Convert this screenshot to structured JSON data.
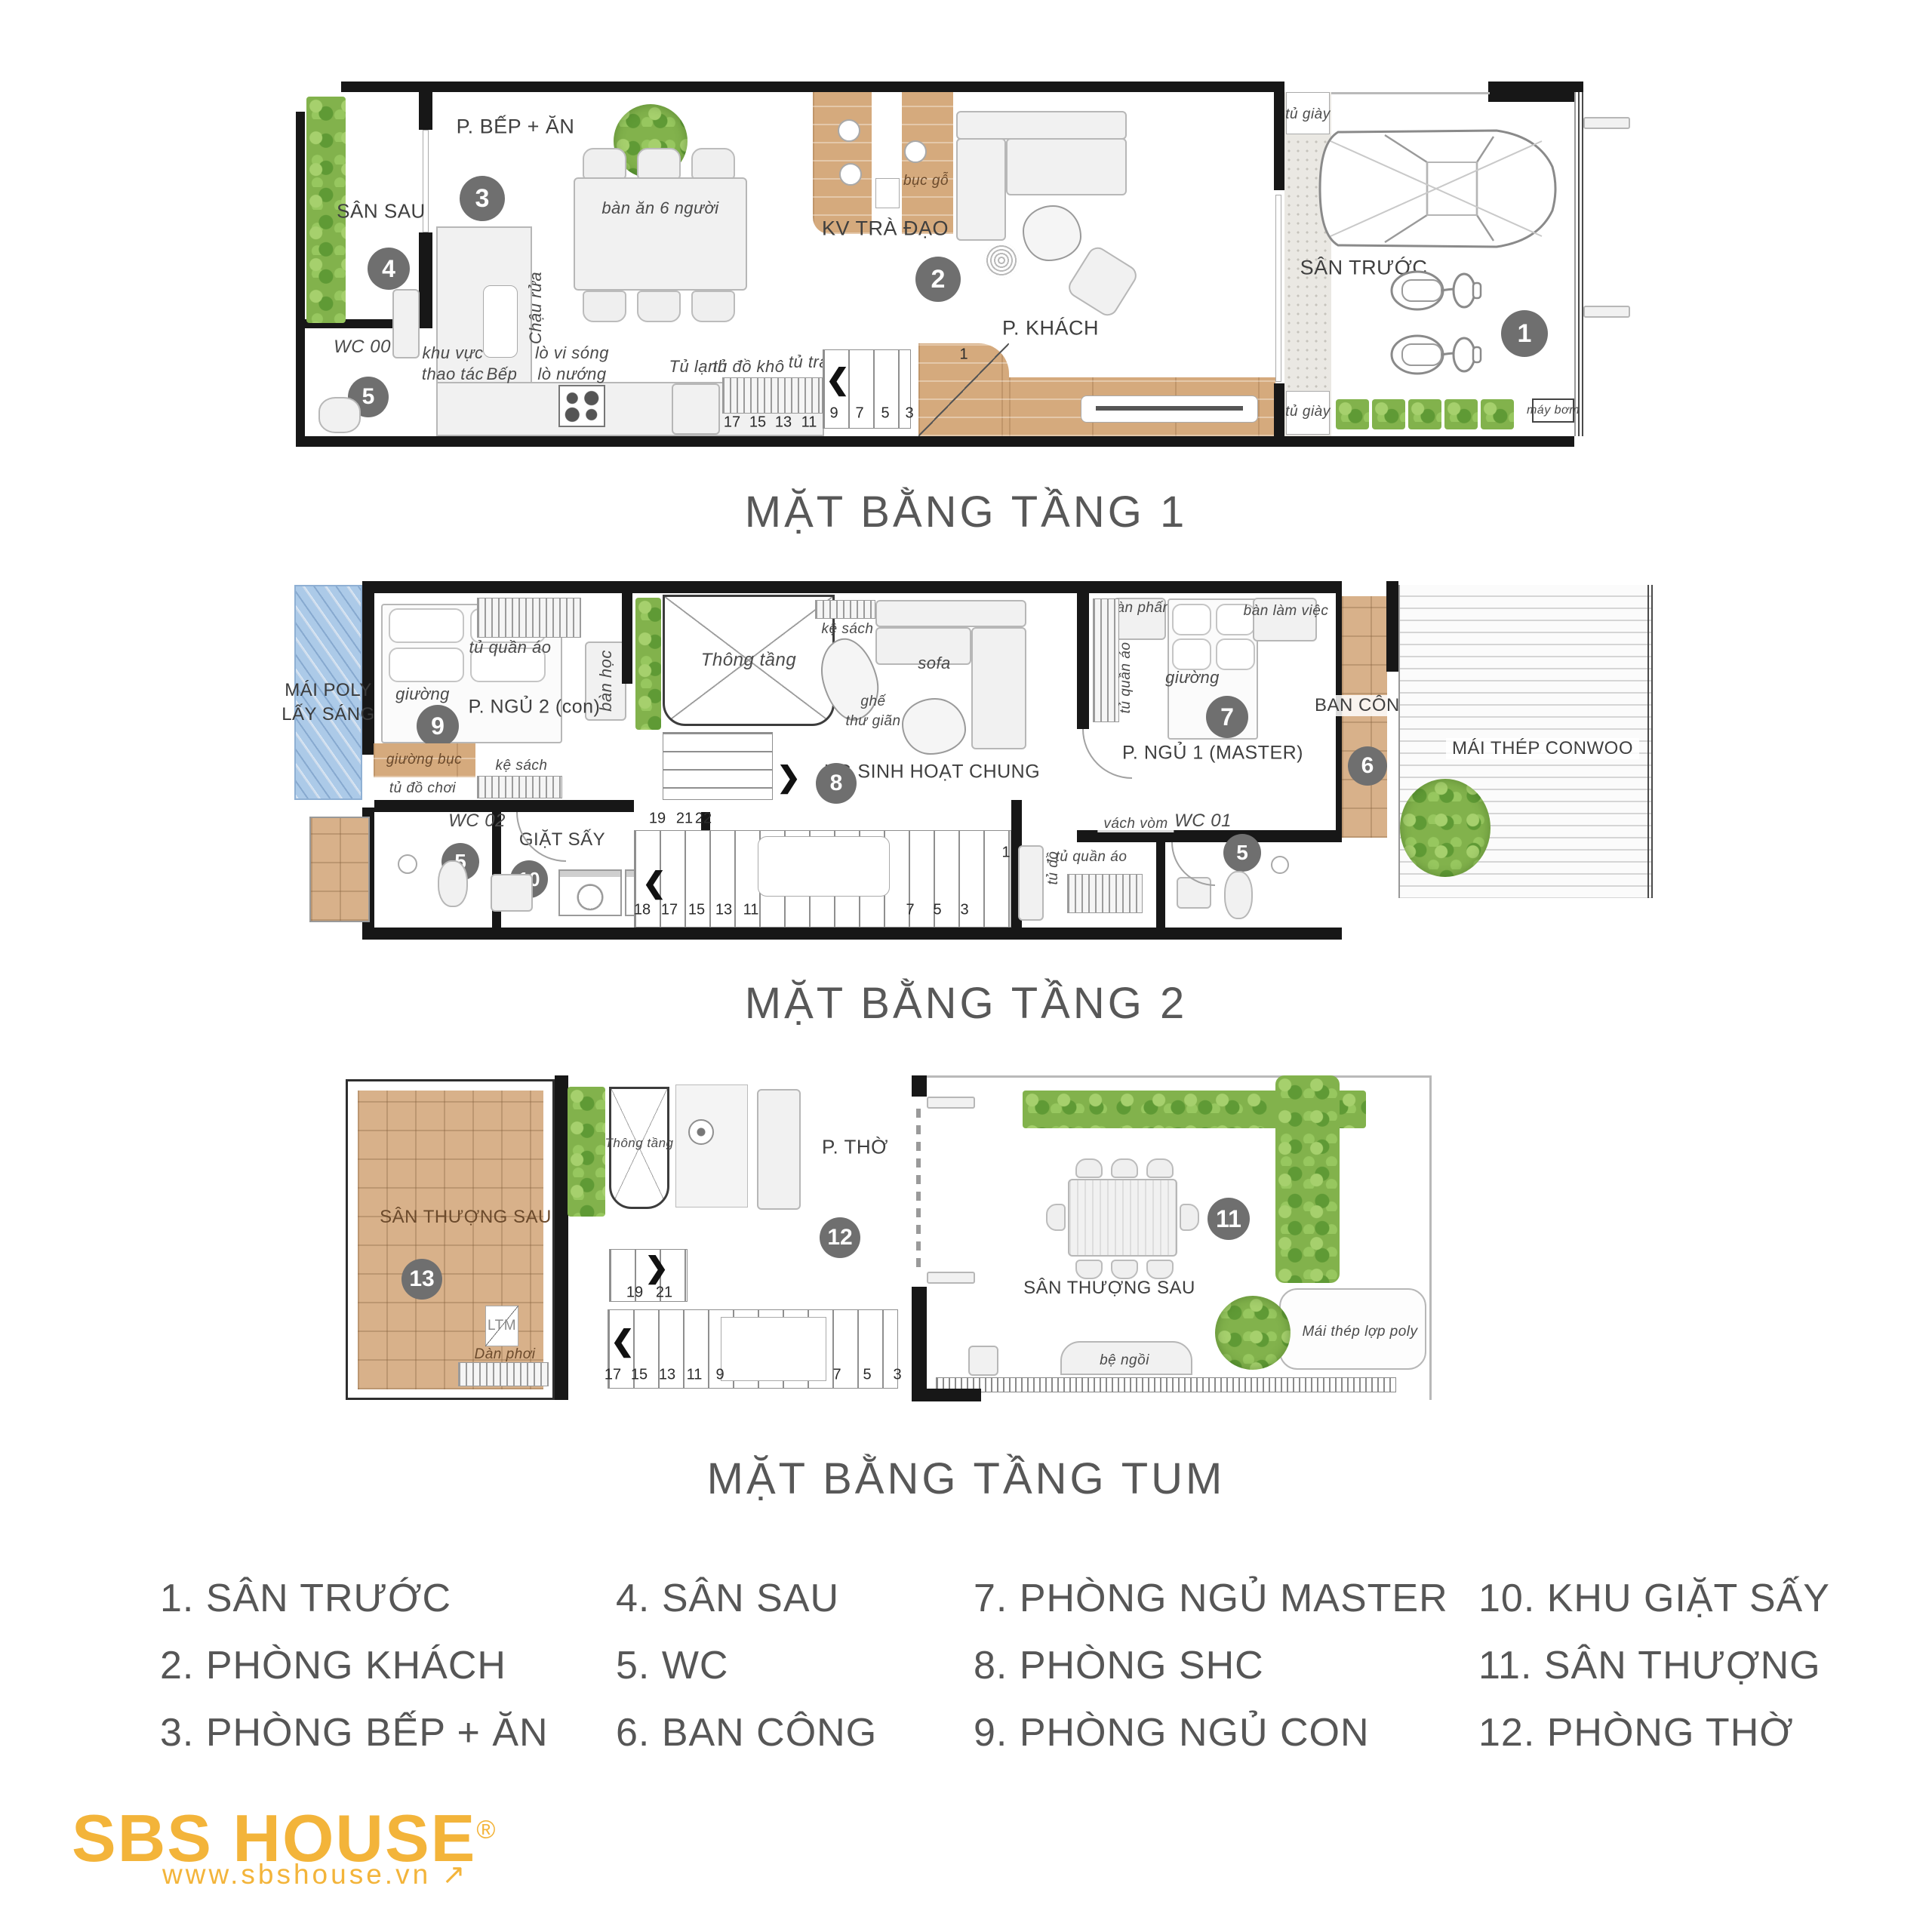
{
  "colors": {
    "wall": "#171717",
    "wood": "#d5aa7d",
    "terrace_tile": "#d8b18a",
    "plants_green": "#82b24c",
    "poly_blue": "#accae8",
    "stone": "#eae8e3",
    "marker_gray": "#6f6f6f",
    "label_gray": "#3f3f3f",
    "title_gray": "#585858",
    "logo_gold": "#f3b43a"
  },
  "titles": {
    "floor1": "MẶT BẰNG TẦNG 1",
    "floor2": "MẶT BẰNG TẦNG 2",
    "tum": "MẶT BẰNG TẦNG TUM"
  },
  "markers": {
    "m1": "1",
    "m2": "2",
    "m3": "3",
    "m4": "4",
    "m5": "5",
    "m6": "6",
    "m7": "7",
    "m8": "8",
    "m9": "9",
    "m10": "10",
    "m11": "11",
    "m12": "12",
    "m13": "13"
  },
  "floor1": {
    "labels": {
      "san_sau": "SÂN SAU",
      "wc00": "WC 00",
      "bep_an": "P. BẾP + ĂN",
      "ban_an": "bàn ăn 6 người",
      "chau_rua": "Chậu rửa",
      "khu_vuc": "khu vực",
      "thao_tac": "thao tác",
      "bep": "Bếp",
      "lo_vi_song": "lò vi sóng",
      "lo_nuong": "lò nướng",
      "tu_lanh": "Tủ lạnh",
      "tu_do_kho": "tủ đồ khô",
      "tu_trang_tri": "tủ trang trí",
      "kv_tra_dao": "KV TRÀ ĐẠO",
      "buc_go": "bục gỗ",
      "p_khach": "P. KHÁCH",
      "tu_giay": "tủ giày",
      "san_truoc": "SÂN TRƯỚC",
      "may_bom": "máy bơm"
    },
    "stairs": [
      "17",
      "15",
      "13",
      "11",
      "9",
      "7",
      "5",
      "3"
    ],
    "stair_top": "1"
  },
  "floor2": {
    "labels": {
      "mai_poly_1": "MÁI POLY",
      "mai_poly_2": "LẤY SÁNG",
      "giuong": "giường",
      "tu_quan_ao": "tủ quần áo",
      "ban_hoc": "bàn học",
      "p_ngu2": "P. NGỦ 2 (con)",
      "giuong_buc": "giường bục",
      "ke_sach": "kệ sách",
      "tu_do_choi": "tủ đồ chơi",
      "wc02": "WC 02",
      "giat_say": "GIẶT SẤY",
      "thong_tang": "Thông tầng",
      "sofa": "sofa",
      "ghe": "ghế",
      "thu_gian": "thư giãn",
      "kg_shc": "KG SINH HOẠT CHUNG",
      "ban_phan": "bàn phấn",
      "ban_lam_viec": "bàn làm việc",
      "p_ngu1": "P. NGỦ 1 (MASTER)",
      "vach_vom": "vách vòm",
      "tu_do": "tủ đồ",
      "wc01": "WC 01",
      "ban_cong": "BAN CÔNG",
      "mai_thep": "MÁI THÉP CONWOO"
    },
    "stairs_top": [
      "19",
      "21",
      "22"
    ],
    "stairs_bottom": [
      "18",
      "17",
      "15",
      "13",
      "11"
    ],
    "stairs_right": [
      "7",
      "5",
      "3"
    ],
    "stair_one": "1"
  },
  "tum": {
    "labels": {
      "san_thuong_sau": "SÂN THƯỢNG SAU",
      "ltm": "LTM",
      "dan_phoi": "Dàn phơi",
      "thong_tang": "Thông tầng",
      "p_tho": "P. THỜ",
      "be_ngoi": "bệ ngồi",
      "mai_thep_poly": "Mái thép lợp poly"
    },
    "stairs_top": [
      "19",
      "21"
    ],
    "stairs_bottom": [
      "17",
      "15",
      "13",
      "11",
      "9",
      "7",
      "5",
      "3"
    ]
  },
  "legend": {
    "items": [
      "1. SÂN TRƯỚC",
      "2. PHÒNG KHÁCH",
      "3. PHÒNG BẾP + ĂN",
      "4. SÂN SAU",
      "5. WC",
      "6. BAN CÔNG",
      "7. PHÒNG NGỦ MASTER",
      "8. PHÒNG SHC",
      "9. PHÒNG NGỦ CON",
      "10. KHU GIẶT SẤY",
      "11. SÂN THƯỢNG",
      "12. PHÒNG THỜ"
    ]
  },
  "logo": {
    "brand": "SBS HOUSE",
    "reg": "®",
    "site": "www.sbshouse.vn",
    "arrow": "↗"
  }
}
